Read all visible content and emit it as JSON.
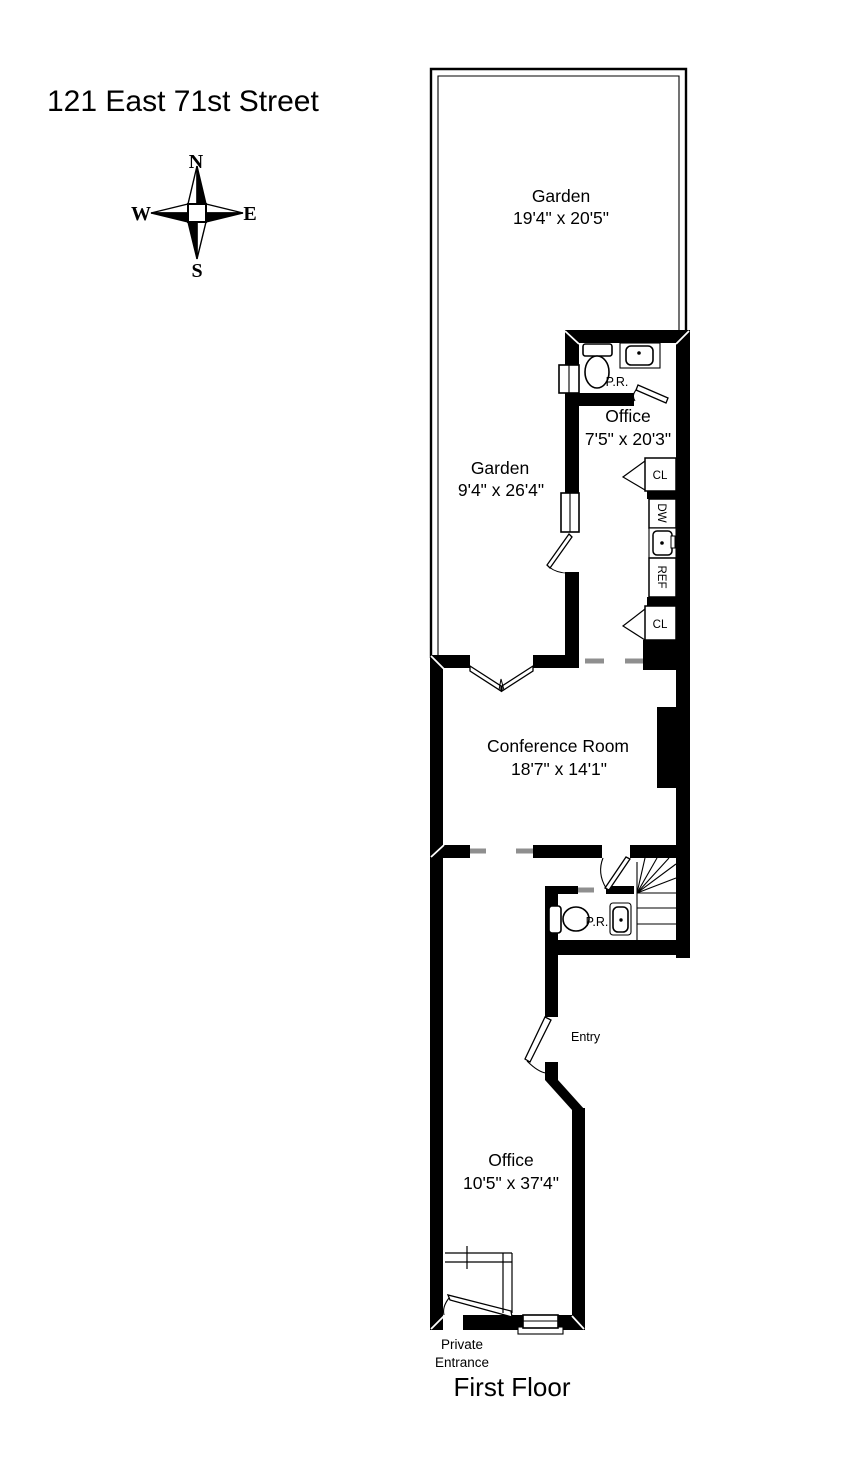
{
  "page": {
    "title": "121 East 71st Street",
    "floor_label": "First Floor"
  },
  "compass": {
    "n": "N",
    "s": "S",
    "e": "E",
    "w": "W"
  },
  "rooms": {
    "garden_top": {
      "name": "Garden",
      "dims": "19'4\" x 20'5\""
    },
    "garden_side": {
      "name": "Garden",
      "dims": "9'4\" x 26'4\""
    },
    "office_top": {
      "name": "Office",
      "dims": "7'5\" x 20'3\""
    },
    "conference": {
      "name": "Conference Room",
      "dims": "18'7\" x 14'1\""
    },
    "office_main": {
      "name": "Office",
      "dims": "10'5\" x 37'4\""
    }
  },
  "labels": {
    "pr_top": "P.R.",
    "pr_mid": "P.R.",
    "entry": "Entry",
    "private_line1": "Private",
    "private_line2": "Entrance",
    "closet_top": "CL",
    "closet_bottom": "CL",
    "dishwasher": "DW",
    "refrigerator": "REF"
  },
  "colors": {
    "wall": "#000000",
    "background": "#ffffff",
    "jamb_gray": "#8f8f8f"
  }
}
